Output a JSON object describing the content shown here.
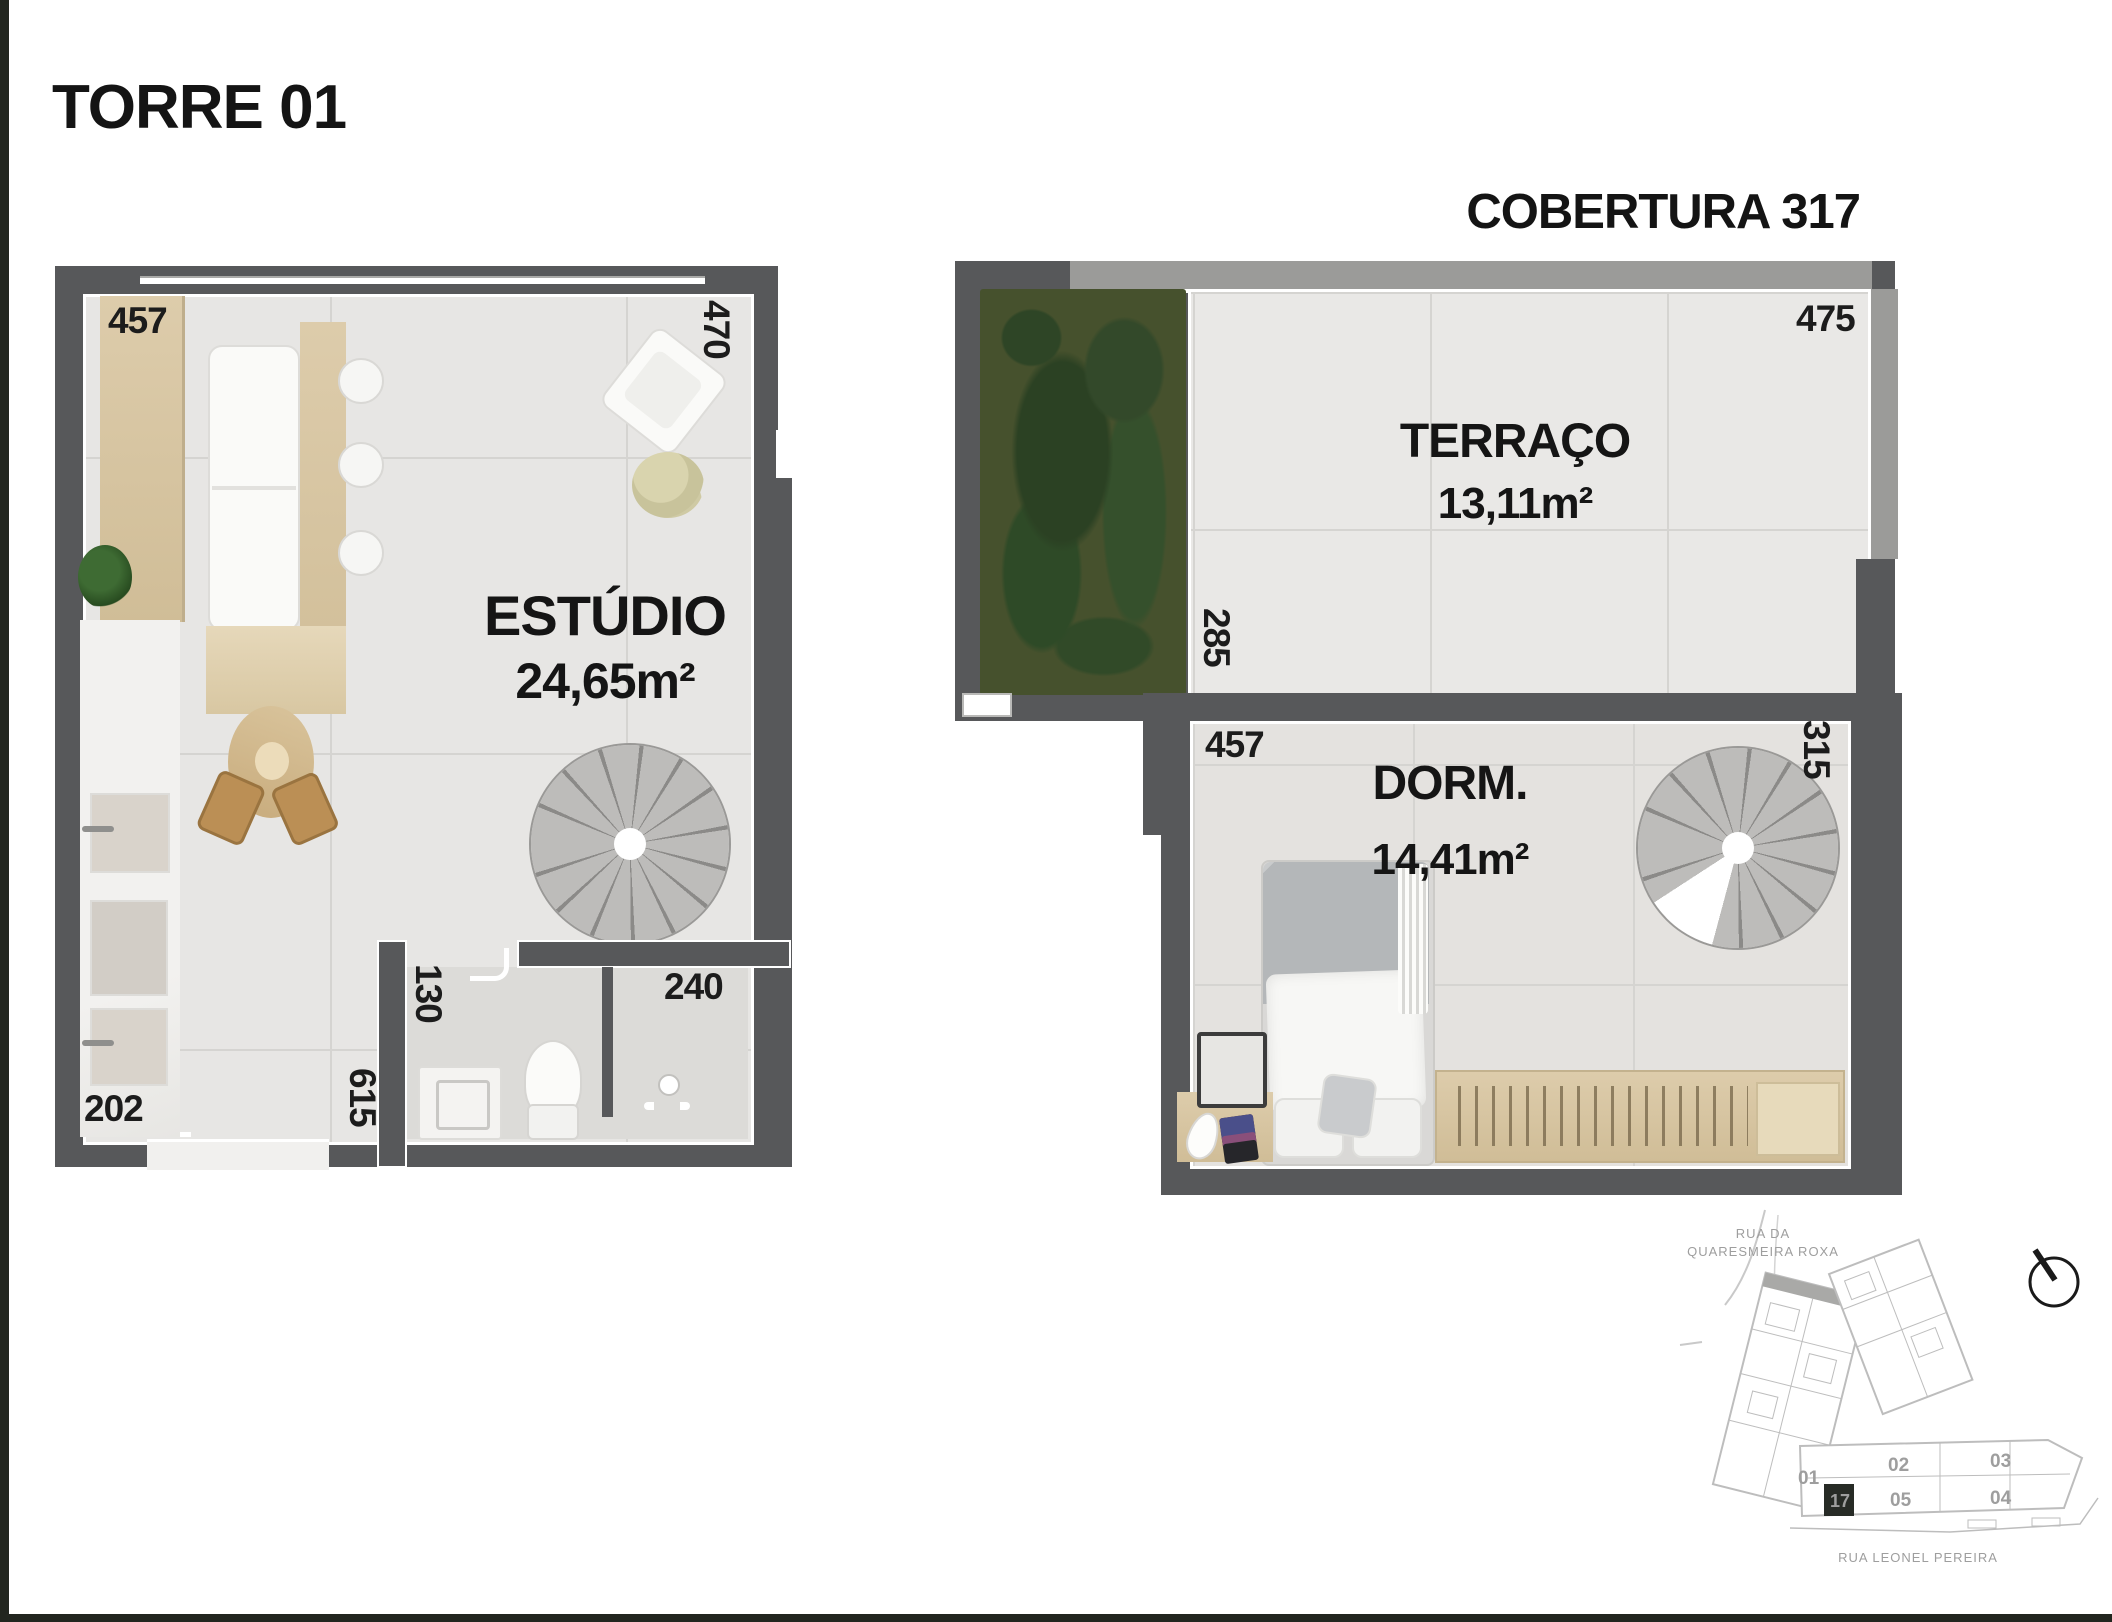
{
  "page": {
    "title": "TORRE 01",
    "unit": "COBERTURA 317"
  },
  "estudio": {
    "label": "ESTÚDIO",
    "area": "24,65m²",
    "dim_top": "457",
    "dim_right": "470",
    "dim_kitchen": "202",
    "dim_bath_door": "130",
    "dim_hall": "615",
    "dim_shower": "240"
  },
  "cobertura": {
    "terrace_label": "TERRAÇO",
    "terrace_area": "13,11m²",
    "dorm_label": "DORM.",
    "dorm_area": "14,41m²",
    "dim_terrace_top": "475",
    "dim_garden": "285",
    "dim_dorm_top": "457",
    "dim_dorm_right": "315"
  },
  "siteplan": {
    "street_top_line1": "RUA DA",
    "street_top_line2": "QUARESMEIRA ROXA",
    "street_bottom": "RUA LEONEL PEREIRA",
    "unit_01": "01",
    "unit_02": "02",
    "unit_03": "03",
    "unit_04": "04",
    "unit_05": "05",
    "highlighted_unit": "17"
  },
  "colors": {
    "wall": "#57585a",
    "floor_tile": "#e7e6e4",
    "wood": "#d6c4a3",
    "garden_green": "#46512d",
    "stair_gray": "#bcbbb9",
    "highlight_badge": "#272b26",
    "ink": "#161616",
    "siteplan_line": "#c2c2c2"
  }
}
